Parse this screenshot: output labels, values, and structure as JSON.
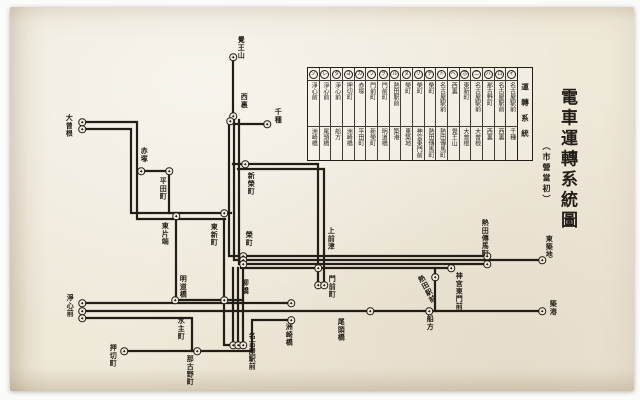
{
  "title": {
    "main": "電車運轉系統圖",
    "sub": "（市營當初）"
  },
  "colors": {
    "ink": "#221d16",
    "paper": "#efe9da"
  },
  "legend": {
    "header": "運轉系統",
    "routes": [
      {
        "mark": "イ",
        "from": "名古屋駅前",
        "to": "千種"
      },
      {
        "mark": "ロ",
        "from": "名古屋駅前",
        "to": "西裏"
      },
      {
        "mark": "ハ",
        "from": "那古野町",
        "to": "西裏"
      },
      {
        "mark": "ニ",
        "from": "名古屋駅前",
        "to": "大曾根"
      },
      {
        "mark": "ホ",
        "from": "東新町",
        "to": "大曾根"
      },
      {
        "mark": "ヘ",
        "from": "西裏",
        "to": "覺王山"
      },
      {
        "mark": "ト",
        "from": "名古屋駅前",
        "to": "熱田傳馬町"
      },
      {
        "mark": "チ",
        "from": "榮町",
        "to": "熱田傳馬町"
      },
      {
        "mark": "リ",
        "from": "榮町",
        "to": "神宮東門前"
      },
      {
        "mark": "ヌ",
        "from": "榮町",
        "to": "東築地"
      },
      {
        "mark": "ル",
        "from": "熱田駅前",
        "to": "築港"
      },
      {
        "mark": "ヲ",
        "from": "門前町",
        "to": "明道橋"
      },
      {
        "mark": "ワ",
        "from": "門前町",
        "to": "新榮町"
      },
      {
        "mark": "カ",
        "from": "赤塚",
        "to": "平田町"
      },
      {
        "mark": "ヨ",
        "from": "押切町",
        "to": "洲崎橋"
      },
      {
        "mark": "タ",
        "from": "淨心前",
        "to": "船方"
      },
      {
        "mark": "レ",
        "from": "淨心前",
        "to": "尾頭橋"
      },
      {
        "mark": "ソ",
        "from": "淨心前",
        "to": "洲崎橋"
      }
    ]
  },
  "map": {
    "stations": [
      {
        "name": "大曾根",
        "label": [
          65,
          114
        ],
        "dots": [
          [
            82,
            122
          ],
          [
            82,
            129
          ]
        ]
      },
      {
        "name": "覺王山",
        "label": [
          237,
          36
        ],
        "dots": [
          [
            233,
            57
          ]
        ]
      },
      {
        "name": "西裏",
        "label": [
          240,
          93
        ],
        "dots": [
          [
            233,
            116
          ],
          [
            230,
            121
          ]
        ]
      },
      {
        "name": "千種",
        "label": [
          274,
          108
        ],
        "dots": [
          [
            267,
            124
          ]
        ]
      },
      {
        "name": "赤塚",
        "label": [
          140,
          147
        ],
        "dots": [
          [
            141,
            171
          ]
        ]
      },
      {
        "name": "平田町",
        "label": [
          159,
          177
        ],
        "dots": [
          [
            169,
            171
          ]
        ]
      },
      {
        "name": "東片端",
        "label": [
          161,
          222
        ],
        "dots": [
          [
            176,
            216
          ]
        ]
      },
      {
        "name": "東新町",
        "label": [
          210,
          223
        ],
        "dots": [
          [
            224,
            213
          ]
        ]
      },
      {
        "name": "新榮町",
        "label": [
          247,
          172
        ],
        "dots": [
          [
            245,
            164
          ]
        ]
      },
      {
        "name": "榮町",
        "label": [
          245,
          231
        ],
        "dots": [
          [
            243,
            256
          ],
          [
            243,
            260
          ],
          [
            243,
            264
          ]
        ]
      },
      {
        "name": "上前津",
        "label": [
          327,
          227
        ],
        "dots": [
          [
            318,
            268
          ]
        ]
      },
      {
        "name": "門前町",
        "label": [
          328,
          275
        ],
        "dots": [
          [
            318,
            285
          ],
          [
            324,
            285
          ]
        ]
      },
      {
        "name": "明道橋",
        "label": [
          179,
          275
        ],
        "dots": [
          [
            175,
            300
          ]
        ]
      },
      {
        "name": "柳橋",
        "label": [
          241,
          279
        ],
        "dots": [
          [
            224,
            300
          ]
        ]
      },
      {
        "name": "淨心前",
        "label": [
          66,
          294
        ],
        "dots": [
          [
            82,
            303
          ],
          [
            82,
            311
          ],
          [
            82,
            318
          ]
        ]
      },
      {
        "name": "水主町",
        "label": [
          177,
          317
        ],
        "dots": []
      },
      {
        "name": "押切町",
        "label": [
          109,
          344
        ],
        "dots": [
          [
            124,
            351
          ]
        ]
      },
      {
        "name": "那古野町",
        "label": [
          186,
          355
        ],
        "dots": [
          [
            197,
            351
          ]
        ]
      },
      {
        "name": "名古屋駅前",
        "label": [
          248,
          332
        ],
        "dots": [
          [
            233,
            345
          ],
          [
            238,
            345
          ],
          [
            243,
            345
          ]
        ]
      },
      {
        "name": "洲崎橋",
        "label": [
          285,
          323
        ],
        "dots": [
          [
            291,
            303
          ],
          [
            291,
            320
          ]
        ]
      },
      {
        "name": "尾頭橋",
        "label": [
          337,
          318
        ],
        "dots": [
          [
            370,
            311
          ]
        ]
      },
      {
        "name": "神宮東門前",
        "label": [
          455,
          272
        ],
        "dots": [
          [
            451,
            268
          ]
        ]
      },
      {
        "name": "熱田駅前",
        "label": [
          423,
          274
        ],
        "dots": [
          [
            435,
            277
          ]
        ],
        "tilt": -28
      },
      {
        "name": "熱田傳馬町",
        "label": [
          481,
          219
        ],
        "dots": [
          [
            487,
            256
          ],
          [
            487,
            264
          ]
        ]
      },
      {
        "name": "東築地",
        "label": [
          545,
          235
        ],
        "dots": [
          [
            542,
            260
          ]
        ]
      },
      {
        "name": "築港",
        "label": [
          549,
          300
        ],
        "dots": [
          [
            542,
            311
          ]
        ]
      },
      {
        "name": "船方",
        "label": [
          426,
          315
        ],
        "dots": [
          [
            429,
            311
          ]
        ]
      }
    ]
  }
}
